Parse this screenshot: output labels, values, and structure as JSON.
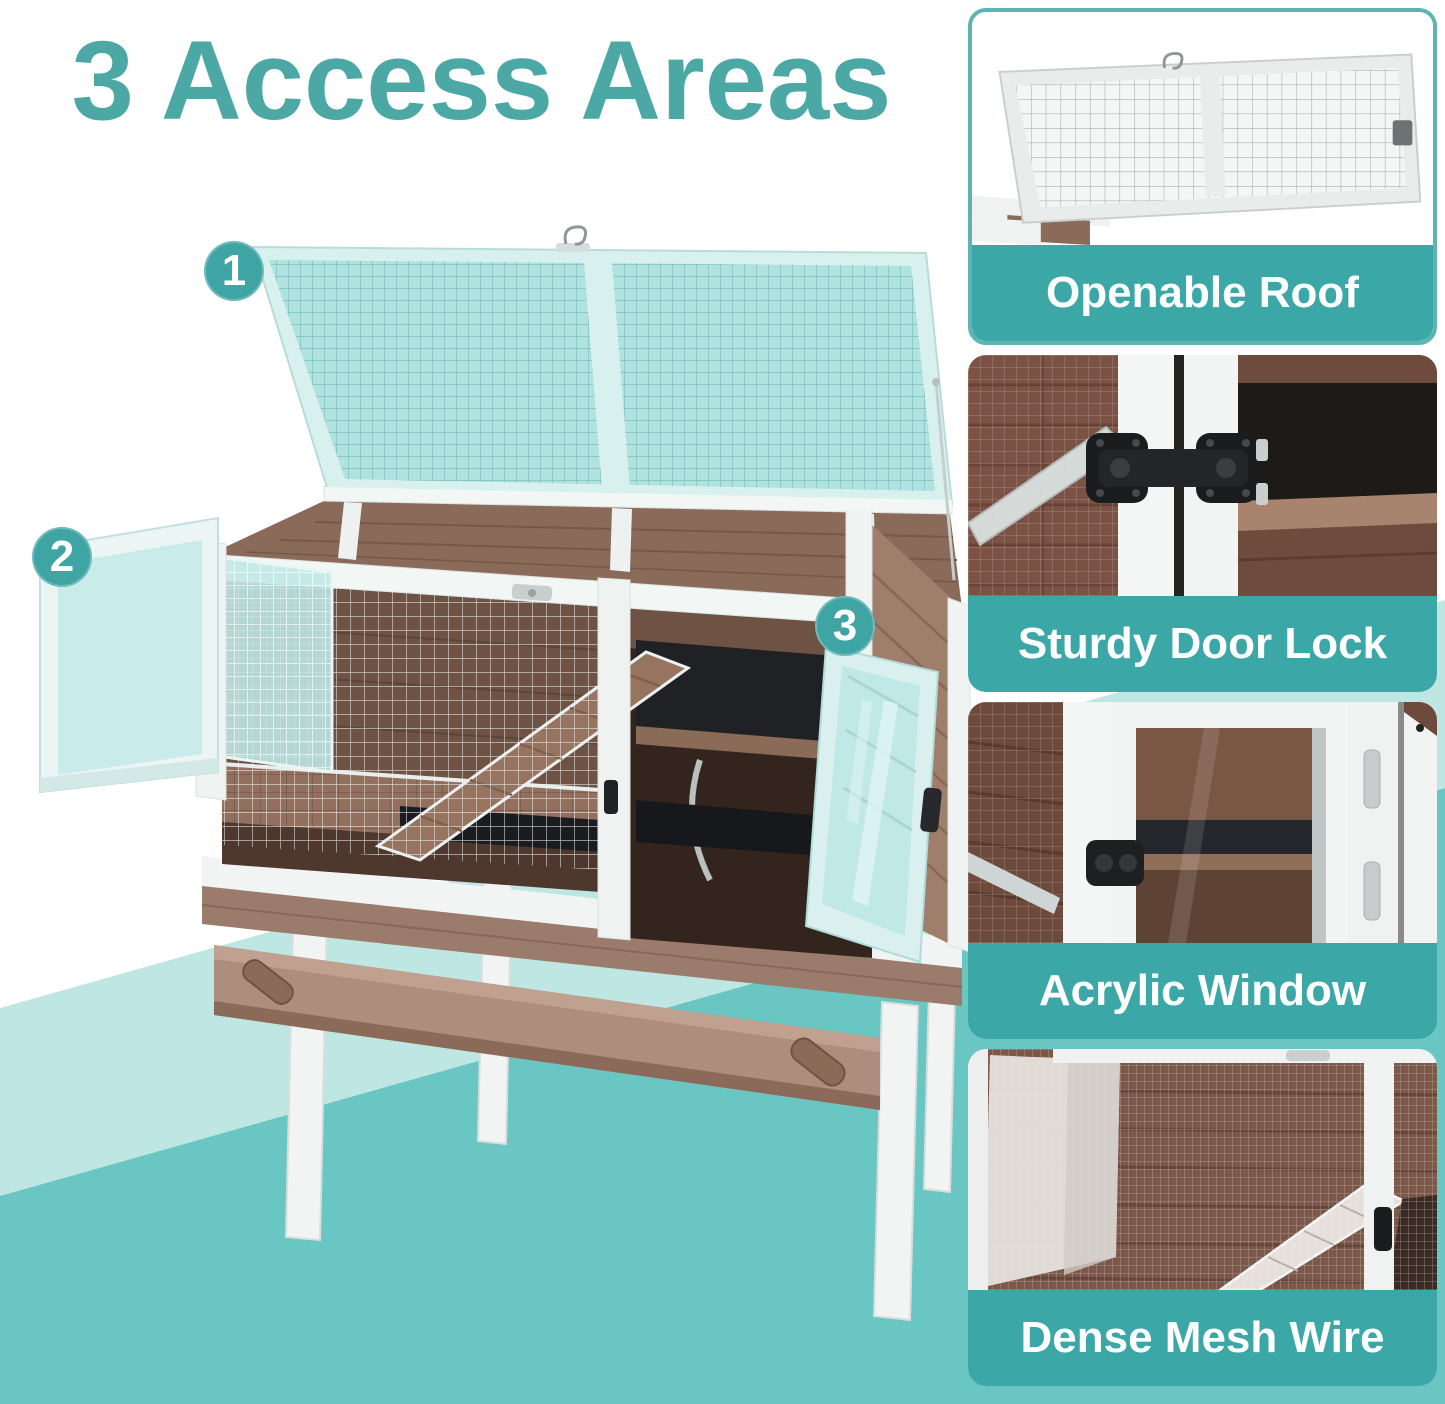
{
  "title": {
    "text": "3 Access Areas"
  },
  "markers": [
    {
      "number": "1"
    },
    {
      "number": "2"
    },
    {
      "number": "3"
    }
  ],
  "features": [
    {
      "label": "Openable Roof"
    },
    {
      "label": "Sturdy Door Lock"
    },
    {
      "label": "Acrylic Window"
    },
    {
      "label": "Dense Mesh Wire"
    }
  ],
  "colors": {
    "title_teal": "#4BA8A5",
    "marker_teal": "#3FA5A4",
    "caption_teal": "#3CA7A7",
    "background_teal": "#69C6C2",
    "background_teal_light": "#BEE7E4",
    "card_border_teal": "#5CB5B2",
    "wood_brown": "#8A6A59",
    "frame_white": "#F2F5F4",
    "highlight_teal": "#BFE8E6"
  }
}
